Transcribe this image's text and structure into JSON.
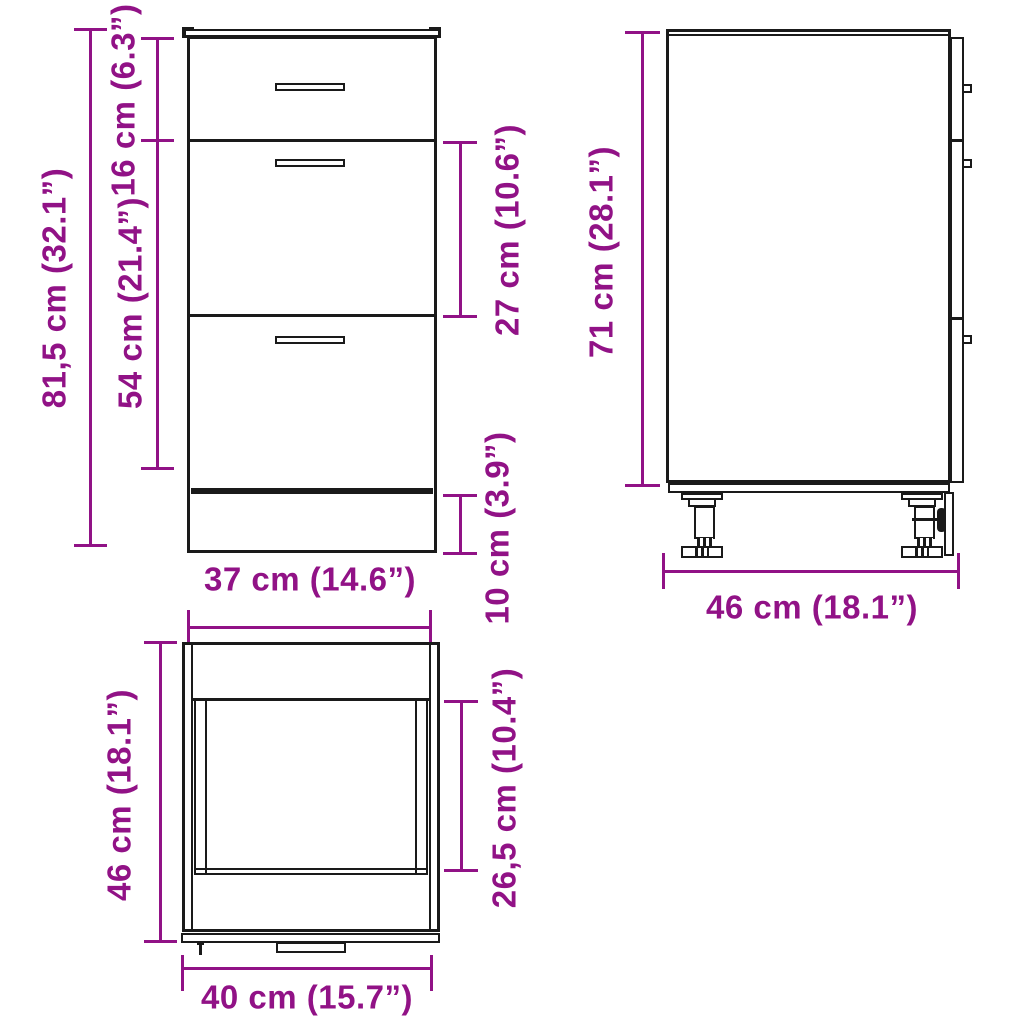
{
  "meta": {
    "accent_color": "#911286",
    "line_color": "#1a1a1a",
    "background_color": "#ffffff",
    "description": "cabinet-dimension-diagram"
  },
  "views": {
    "front": {
      "name": "front view",
      "dims": {
        "total_height": "81,5 cm (32.1”)",
        "top_drawer_height": "16 cm (6.3”)",
        "lower_section_height": "54 cm (21.4”)",
        "middle_drawer_height": "27 cm (10.6”)",
        "plinth_height": "10 cm (3.9”)",
        "width": "37 cm (14.6”)"
      }
    },
    "side": {
      "name": "side view",
      "dims": {
        "body_height": "71 cm (28.1”)",
        "depth": "46 cm (18.1”)"
      }
    },
    "top": {
      "name": "top view",
      "dims": {
        "depth": "46 cm (18.1”)",
        "inner_depth": "26,5 cm (10.4”)",
        "width": "40 cm (15.7”)"
      }
    }
  }
}
